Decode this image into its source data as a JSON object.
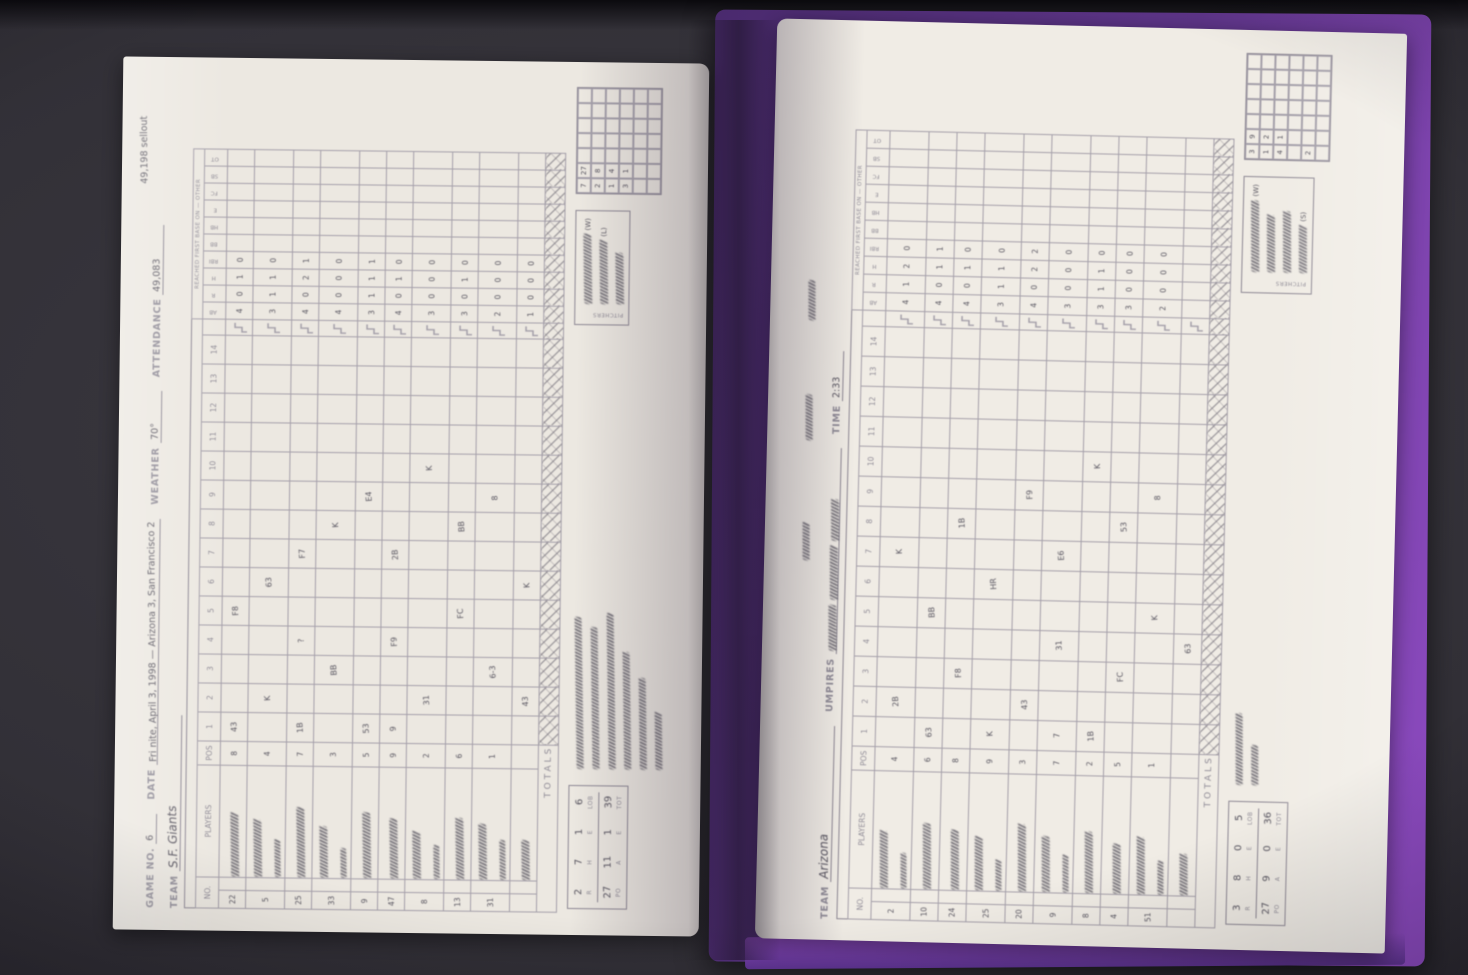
{
  "scene": {
    "background_color": "#312f36",
    "cover_color": "#5e3589",
    "cover_bottom_color": "#7d3fae",
    "page_color": "#ece8e1",
    "grid_line_color": "#a49fa9",
    "printed_text_color": "#8f8b96",
    "handwriting_color": "#56535e",
    "description": "Photograph of an open purple-covered baseball scorebook, pages turned sideways (scoresheets rotated 90°), on a dark table"
  },
  "left_page": {
    "margin_note": "49,198 sellout",
    "header": {
      "game_no_label": "GAME NO.",
      "game_no_value": "6",
      "date_label": "DATE",
      "date_value": "Fri nite, April 3, 1998 — Arizona 3, San Francisco 2",
      "weather_label": "WEATHER",
      "weather_value": "70°",
      "attendance_label": "ATTENDANCE",
      "attendance_value": "49,083",
      "team_label": "TEAM",
      "team_value": "S.F. Giants"
    },
    "grid": {
      "no_label": "NO.",
      "players_label": "PLAYERS",
      "pos_label": "POS",
      "innings": [
        "1",
        "2",
        "3",
        "4",
        "5",
        "6",
        "7",
        "8",
        "9",
        "10",
        "11",
        "12",
        "13",
        "14"
      ],
      "stat_cols": [
        "AB",
        "R",
        "H",
        "RBI"
      ],
      "reach_cols": [
        "BB",
        "HB",
        "E",
        "FC",
        "SB",
        "OT"
      ],
      "reach_caption": "REACHED FIRST BASE ON — OTHER",
      "totals_label": "TOTALS"
    },
    "rows": {
      "numbers": [
        "22",
        "5",
        "25",
        "33",
        "9",
        "47",
        "8",
        "13",
        "31",
        ""
      ],
      "positions": [
        "8",
        "4",
        "7",
        "3",
        "5",
        "9",
        "2",
        "6",
        "1",
        ""
      ],
      "name_scribbles": [
        64,
        58,
        70,
        52,
        66,
        60,
        48,
        62,
        56,
        40
      ],
      "sub_scribbles": [
        0,
        38,
        0,
        30,
        0,
        0,
        34,
        0,
        40,
        0
      ],
      "stats_rows": [
        "4 0 1 0",
        "3 1 1 0",
        "4 0 2 1",
        "4 0 0 0",
        "3 1 1 1",
        "4 0 1 0",
        "3 0 0 0",
        "3 0 1 0",
        "2 0 0 0",
        "1 0 0 0"
      ]
    },
    "inning_marks": [
      [
        0,
        0,
        "43"
      ],
      [
        0,
        4,
        "F8"
      ],
      [
        1,
        1,
        "K"
      ],
      [
        1,
        5,
        "63"
      ],
      [
        2,
        0,
        "1B"
      ],
      [
        2,
        3,
        "?"
      ],
      [
        2,
        6,
        "F7"
      ],
      [
        3,
        2,
        "BB"
      ],
      [
        3,
        7,
        "K"
      ],
      [
        4,
        0,
        "53"
      ],
      [
        4,
        8,
        "E4"
      ],
      [
        5,
        0,
        "9"
      ],
      [
        5,
        3,
        "F9"
      ],
      [
        5,
        6,
        "2B"
      ],
      [
        6,
        1,
        "31"
      ],
      [
        6,
        9,
        "K"
      ],
      [
        7,
        4,
        "FC"
      ],
      [
        7,
        7,
        "BB"
      ],
      [
        8,
        2,
        "6-3"
      ],
      [
        8,
        8,
        "8"
      ],
      [
        9,
        1,
        "43"
      ],
      [
        9,
        5,
        "K"
      ]
    ],
    "summary": {
      "top_labels": [
        "R",
        "H",
        "E",
        "LOB"
      ],
      "top_values": [
        "2",
        "7",
        "1",
        "6"
      ],
      "bottom_labels": [
        "PO",
        "A",
        "E",
        "TOT"
      ],
      "bottom_values": [
        "27",
        "11",
        "1",
        "39"
      ]
    },
    "pitchers_label": "PITCHERS",
    "pitcher_lines": [
      {
        "scribble": 70,
        "tag": "(W)"
      },
      {
        "scribble": 64,
        "tag": "(L)"
      },
      {
        "scribble": 52,
        "tag": ""
      }
    ],
    "note_scribbles": [
      152,
      142,
      156,
      118,
      92,
      58
    ],
    "minigrid": [
      "7 27",
      "2 8",
      "1 4",
      "3 1",
      "",
      ""
    ]
  },
  "right_page": {
    "margin_note_scribbles": [
      38,
      46,
      40
    ],
    "header": {
      "team_label": "TEAM",
      "team_value": "Arizona",
      "umpires_label": "UMPIRES",
      "umpire_scribbles": [
        46,
        54,
        42
      ],
      "time_label": "TIME",
      "time_value": "2:33"
    },
    "grid": {
      "no_label": "NO.",
      "players_label": "PLAYERS",
      "pos_label": "POS",
      "innings": [
        "1",
        "2",
        "3",
        "4",
        "5",
        "6",
        "7",
        "8",
        "9",
        "10",
        "11",
        "12",
        "13",
        "14"
      ],
      "stat_cols": [
        "AB",
        "R",
        "H",
        "RBI"
      ],
      "reach_cols": [
        "BB",
        "HB",
        "E",
        "FC",
        "SB",
        "OT"
      ],
      "reach_caption": "REACHED FIRST BASE ON — OTHER",
      "totals_label": "TOTALS"
    },
    "rows": {
      "numbers": [
        "2",
        "10",
        "24",
        "25",
        "20",
        "9",
        "8",
        "4",
        "51",
        ""
      ],
      "positions": [
        "4",
        "6",
        "8",
        "9",
        "3",
        "7",
        "2",
        "5",
        "1",
        ""
      ],
      "name_scribbles": [
        58,
        66,
        60,
        54,
        68,
        56,
        62,
        50,
        58,
        42
      ],
      "sub_scribbles": [
        36,
        0,
        0,
        32,
        0,
        38,
        0,
        0,
        34,
        0
      ],
      "stats_rows": [
        "4 1 2 0",
        "4 0 1 1",
        "4 0 1 0",
        "3 1 1 0",
        "4 0 2 2",
        "3 0 0 0",
        "3 1 1 0",
        "3 0 0 0",
        "2 0 0 0",
        ""
      ]
    },
    "inning_marks": [
      [
        0,
        1,
        "2B"
      ],
      [
        0,
        6,
        "K"
      ],
      [
        1,
        0,
        "63"
      ],
      [
        1,
        4,
        "BB"
      ],
      [
        2,
        2,
        "F8"
      ],
      [
        2,
        7,
        "1B"
      ],
      [
        3,
        0,
        "K"
      ],
      [
        3,
        5,
        "HR"
      ],
      [
        4,
        1,
        "43"
      ],
      [
        4,
        8,
        "F9"
      ],
      [
        5,
        3,
        "31"
      ],
      [
        5,
        6,
        "E6"
      ],
      [
        6,
        0,
        "1B"
      ],
      [
        6,
        9,
        "K"
      ],
      [
        7,
        2,
        "FC"
      ],
      [
        7,
        7,
        "53"
      ],
      [
        8,
        4,
        "K"
      ],
      [
        8,
        8,
        "8"
      ],
      [
        9,
        3,
        "63"
      ],
      [
        5,
        0,
        "7"
      ]
    ],
    "summary": {
      "top_labels": [
        "R",
        "H",
        "E",
        "LOB"
      ],
      "top_values": [
        "3",
        "8",
        "0",
        "5"
      ],
      "bottom_labels": [
        "PO",
        "A",
        "E",
        "TOT"
      ],
      "bottom_values": [
        "27",
        "9",
        "0",
        "36"
      ]
    },
    "pitchers_label": "PITCHERS",
    "pitcher_lines": [
      {
        "scribble": 72,
        "tag": "(W)"
      },
      {
        "scribble": 58,
        "tag": ""
      },
      {
        "scribble": 62,
        "tag": ""
      },
      {
        "scribble": 48,
        "tag": "(S)"
      }
    ],
    "note_scribbles": [
      72,
      40
    ],
    "minigrid": [
      "3 9",
      "1 2",
      "4 1",
      "",
      "2",
      ""
    ]
  }
}
